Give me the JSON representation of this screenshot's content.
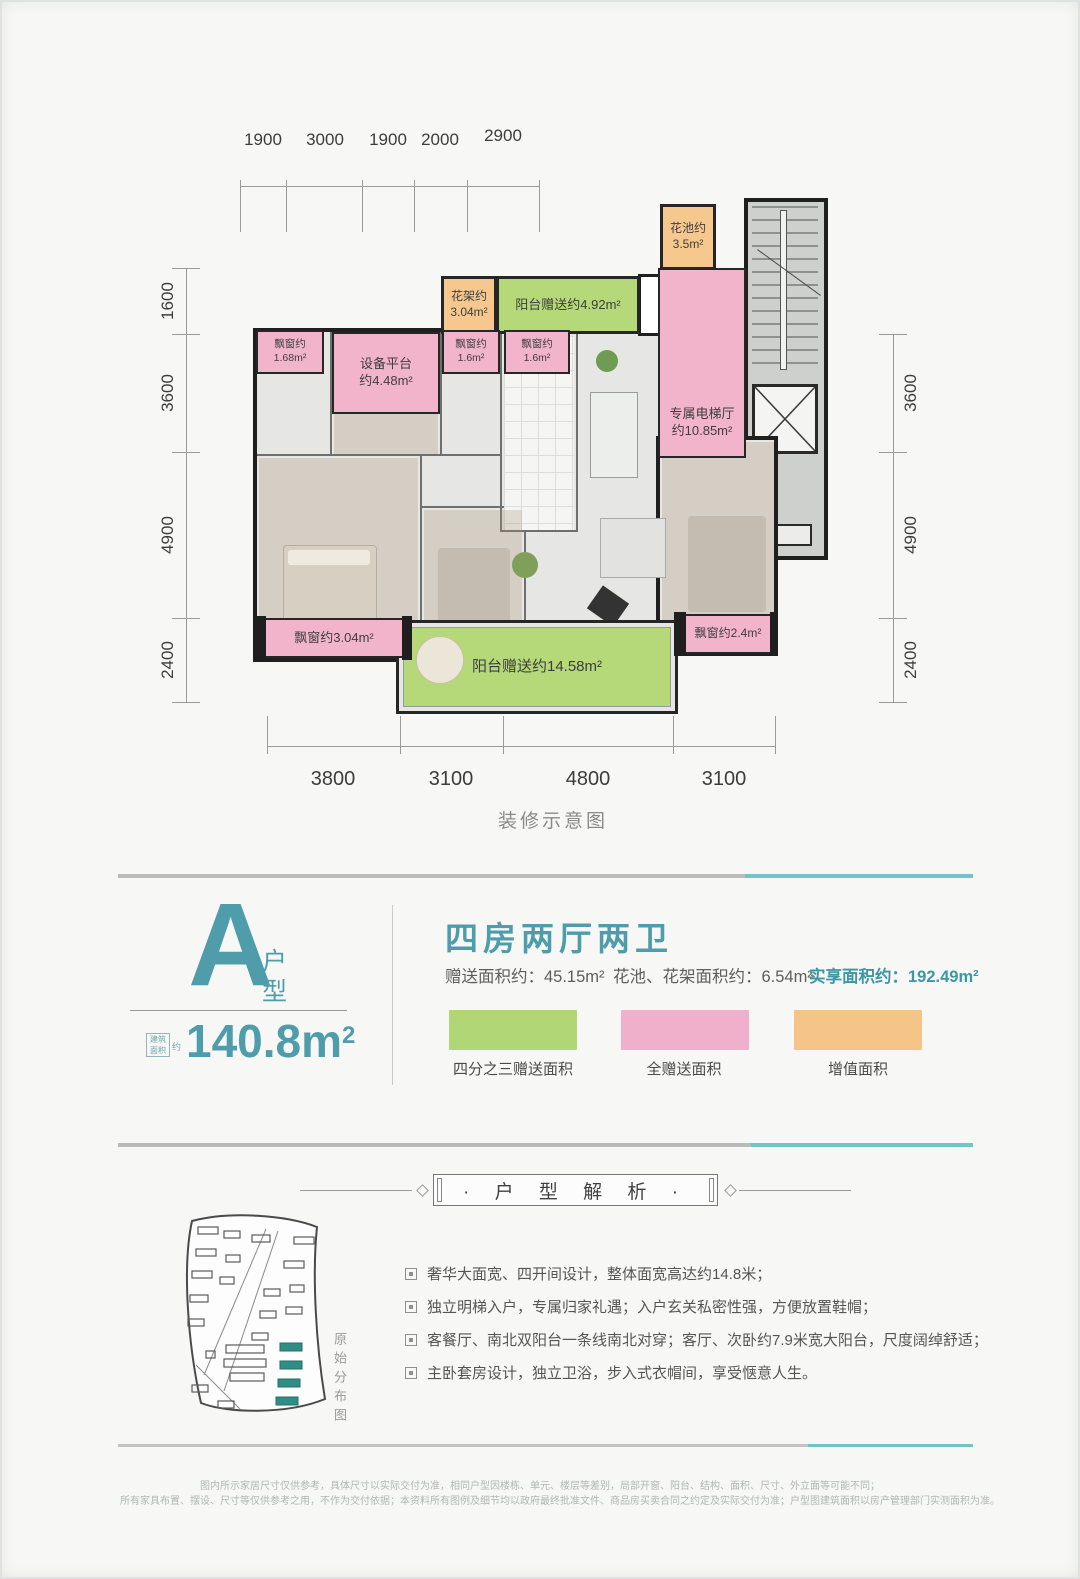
{
  "plan": {
    "caption": "装修示意图",
    "dims": {
      "top": [
        "1900",
        "3000",
        "1900",
        "2000",
        "2900"
      ],
      "left": [
        "1600",
        "3600",
        "4900",
        "2400"
      ],
      "right": [
        "3600",
        "4900",
        "2400"
      ],
      "bottom": [
        "3800",
        "3100",
        "4800",
        "3100"
      ]
    },
    "zones": {
      "flower_pool": {
        "name": "花池约",
        "area": "3.5m²"
      },
      "flower_rack": {
        "name": "花架约",
        "area": "3.04m²"
      },
      "balcony_top": {
        "name": "阳台赠送约",
        "area": "4.92m²"
      },
      "bay1": {
        "name": "飘窗约",
        "area": "1.68m²"
      },
      "equipment": {
        "name": "设备平台",
        "area": "约4.48m²"
      },
      "bay2": {
        "name": "飘窗约",
        "area": "1.6m²"
      },
      "bay3": {
        "name": "飘窗约",
        "area": "1.6m²"
      },
      "elevator_hall": {
        "name": "专属电梯厅",
        "area": "约10.85m²"
      },
      "bay4": {
        "name": "飘窗约",
        "area": "3.04m²"
      },
      "balcony_bottom": {
        "name": "阳台赠送约",
        "area": "14.58m²"
      },
      "bay5": {
        "name": "飘窗约",
        "area": "2.4m²"
      }
    }
  },
  "info": {
    "unit_letter": "A",
    "unit_type": [
      "户",
      "型"
    ],
    "area_badge_line1": "建筑",
    "area_badge_line2": "面积",
    "area_badge_suffix": "约",
    "area_value": "140.8m",
    "area_sup": "2",
    "title": "四房两厅两卫",
    "stats": [
      "赠送面积约：45.15m²",
      "花池、花架面积约：6.54m²",
      "实享面积约：192.49m²"
    ],
    "legend": [
      {
        "label": "四分之三赠送面积",
        "color": "#b1d675"
      },
      {
        "label": "全赠送面积",
        "color": "#f0b0cb"
      },
      {
        "label": "增值面积",
        "color": "#f4c489"
      }
    ]
  },
  "analysis": {
    "header": "· 户 型 解 析 ·",
    "siteplan_caption": "原始分布图",
    "bullets": [
      "奢华大面宽、四开间设计，整体面宽高达约14.8米；",
      "独立明梯入户，专属归家礼遇；入户玄关私密性强，方便放置鞋帽；",
      "客餐厅、南北双阳台一条线南北对穿；客厅、次卧约7.9米宽大阳台，尺度阔绰舒适；",
      "主卧套房设计，独立卫浴，步入式衣帽间，享受惬意人生。"
    ]
  },
  "footer": {
    "line1": "图内所示家居尺寸仅供参考，具体尺寸以实际交付为准，相同户型因楼栋、单元、楼层等差别，局部开窗、阳台、结构、面积、尺寸、外立面等可能不同；",
    "line2": "所有家具布置、摆设、尺寸等仅供参考之用，不作为交付依据；本资料所有图例及细节均以政府最终批准文件、商品房买卖合同之约定及实际交付为准；户型图建筑面积以房产管理部门实测面积为准。"
  },
  "colors": {
    "accent_teal": "#4f9dab",
    "divider_teal": "#74c3c6",
    "zone_green": "#b5d878",
    "zone_pink": "#f2b4ca",
    "zone_orange": "#f6c88e"
  }
}
